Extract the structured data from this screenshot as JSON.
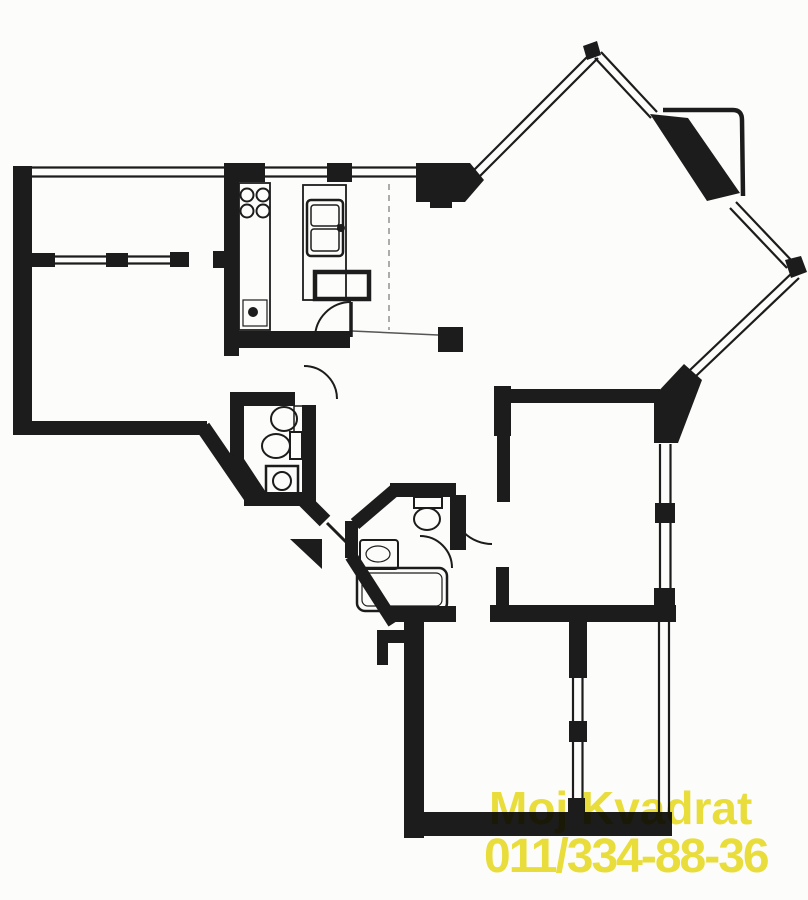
{
  "watermark": {
    "line1": "Moj Kvadrat",
    "line2": "011/334-88-36",
    "color": "#ece03c"
  },
  "plan": {
    "ink_color": "#1c1c1c",
    "paper_color": "#fcfcfa",
    "drawing_type": "apartment-floor-plan-scan",
    "depicted_symbols": [
      "window-strips",
      "door-swing-arcs",
      "entrance-arrow",
      "balcony-railing",
      "structural-column",
      "diamond-shaped-living-room"
    ],
    "depicted_fixtures": [
      "stove-4-burners",
      "kitchen-double-sink",
      "kitchen-table",
      "wc-sink",
      "wc-toilet",
      "washing-machine",
      "bathroom-toilet",
      "bathroom-sink",
      "bathtub"
    ]
  }
}
